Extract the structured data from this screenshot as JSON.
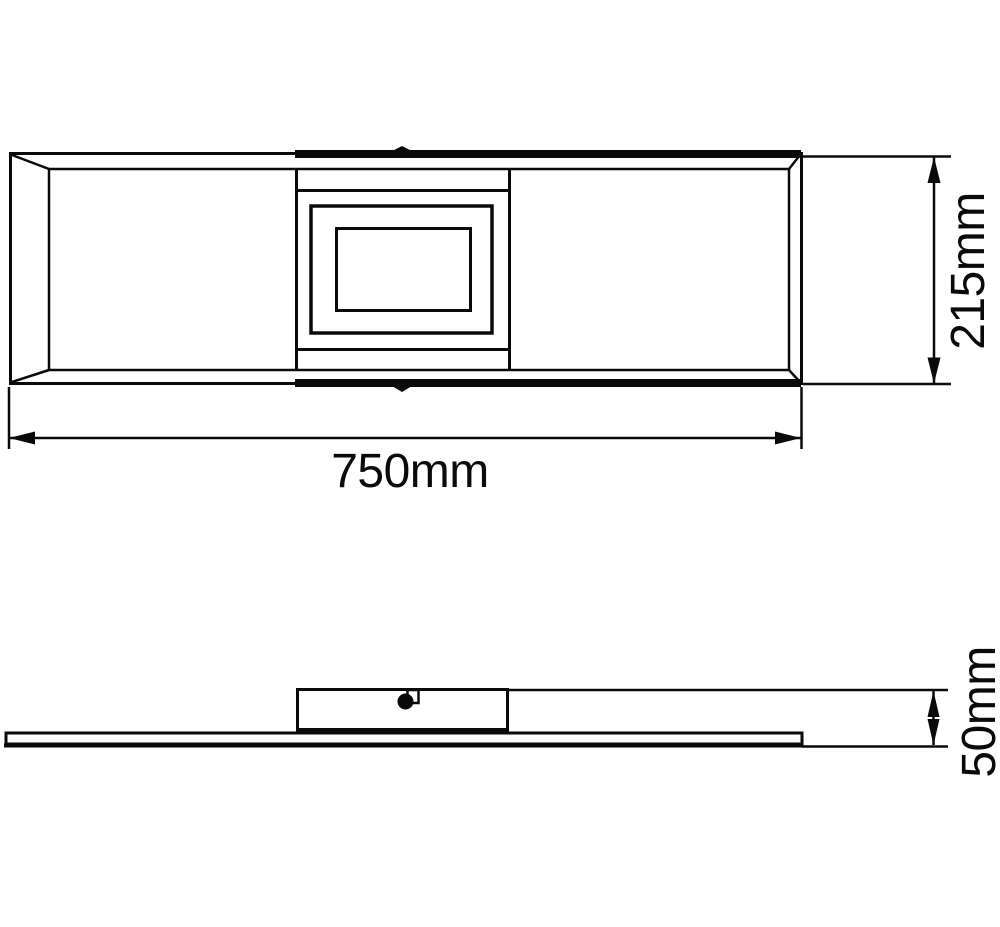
{
  "colors": {
    "line": "#0a0a0a",
    "background": "#ffffff"
  },
  "dimensions": {
    "width": {
      "label": "750mm",
      "value": 750,
      "unit": "mm"
    },
    "height": {
      "label": "215mm",
      "value": 215,
      "unit": "mm"
    },
    "depth": {
      "label": "50mm",
      "value": 50,
      "unit": "mm"
    }
  }
}
